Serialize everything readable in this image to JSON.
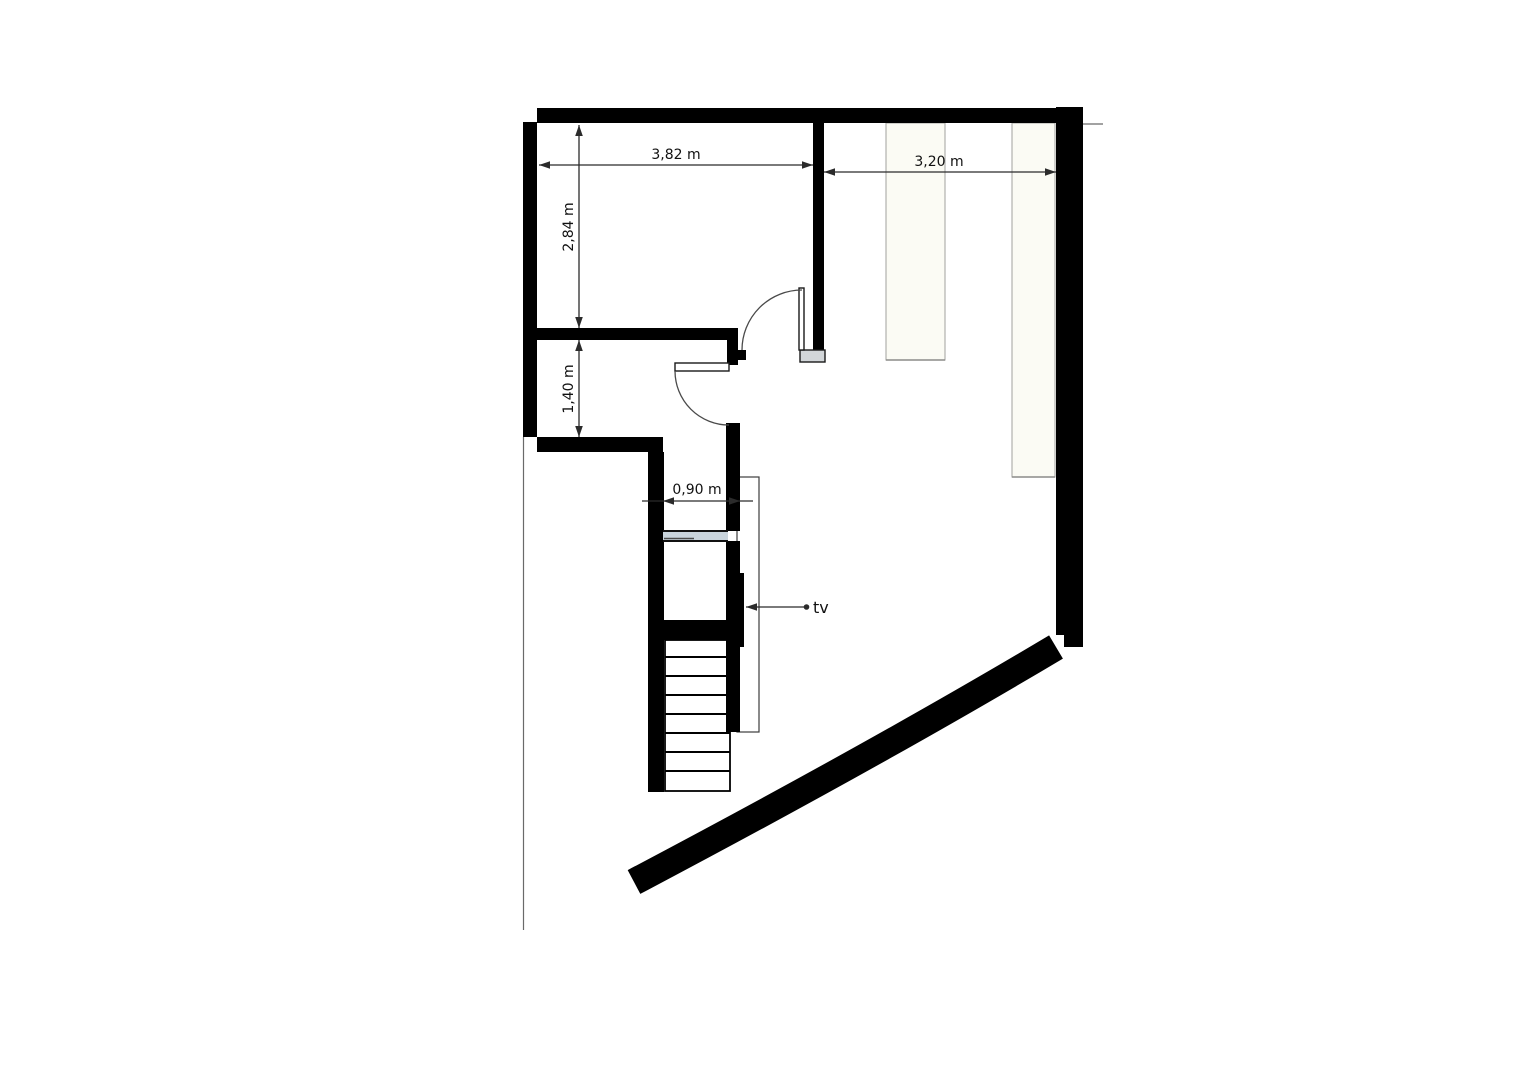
{
  "plan": {
    "dimension_labels": {
      "top_left_width": "3,82 m",
      "top_right_width": "3,20 m",
      "upper_left_height": "2,84 m",
      "lower_left_height": "1,40 m",
      "stair_opening_width": "0,90 m"
    },
    "annotations": {
      "tv_label": "tv"
    },
    "colors": {
      "wall": "#000000",
      "glass": "#c9d4dc",
      "threshold": "#d2d6d9",
      "dim": "#2b2b2b",
      "text": "#111111",
      "furniture_fill": "#fbfbf4",
      "background": "#ffffff"
    }
  }
}
